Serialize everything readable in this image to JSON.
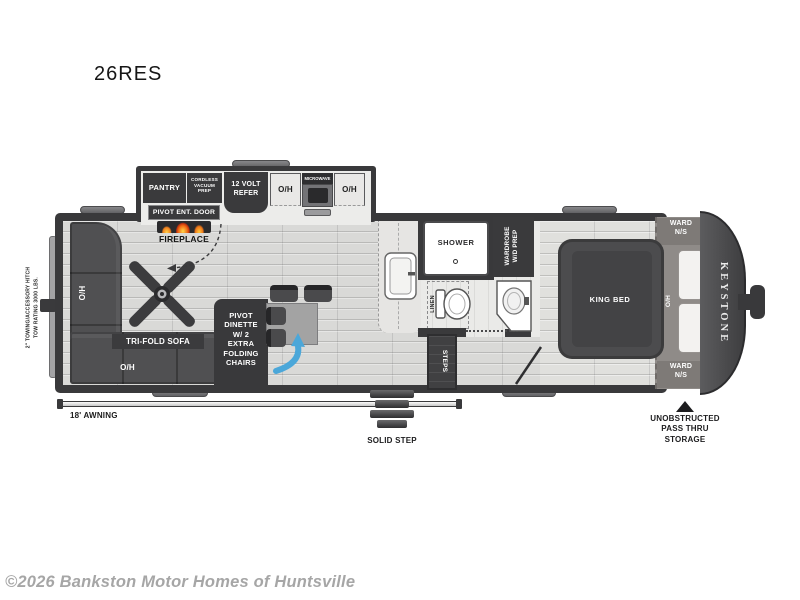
{
  "page": {
    "title": "26RES",
    "copyright": "©2026 Bankston Motor Homes of Huntsville"
  },
  "brand": "KEYSTONE",
  "labels": {
    "pantry": "PANTRY",
    "vacuum_prep": "CORDLESS\nVACUUM\nPREP",
    "refer": "12 VOLT\nREFER",
    "oh": "O/H",
    "microwave": "MICROWAVE",
    "entry_door": "PIVOT ENT. DOOR",
    "fireplace": "FIREPLACE",
    "sofa": "TRI-FOLD SOFA",
    "dinette": "PIVOT\nDINETTE\nW/ 2\nEXTRA\nFOLDING\nCHAIRS",
    "shower": "SHOWER",
    "wardrobe_wd": "WARDROBE\nW/D PREP",
    "linen": "LINEN",
    "steps": "STEPS",
    "king_bed": "KING BED",
    "ward_ns": "WARD\nN/S",
    "hitch_note": "2\" TOWING/ACCESSORY HITCH\nTOW RATING 3000 LBS.",
    "awning": "18' AWNING",
    "solid_step": "SOLID STEP",
    "pass_thru": "UNOBSTRUCTED\nPASS THRU\nSTORAGE"
  },
  "colors": {
    "wall": "#39393b",
    "floor": "#d9d9d7",
    "label_box": "#3a3a3c",
    "arrow_blue": "#4ba7d9",
    "flame_orange": "#f5821f",
    "front_cap": "#4b4b4d",
    "copyright_gray": "#a6a6a6"
  }
}
